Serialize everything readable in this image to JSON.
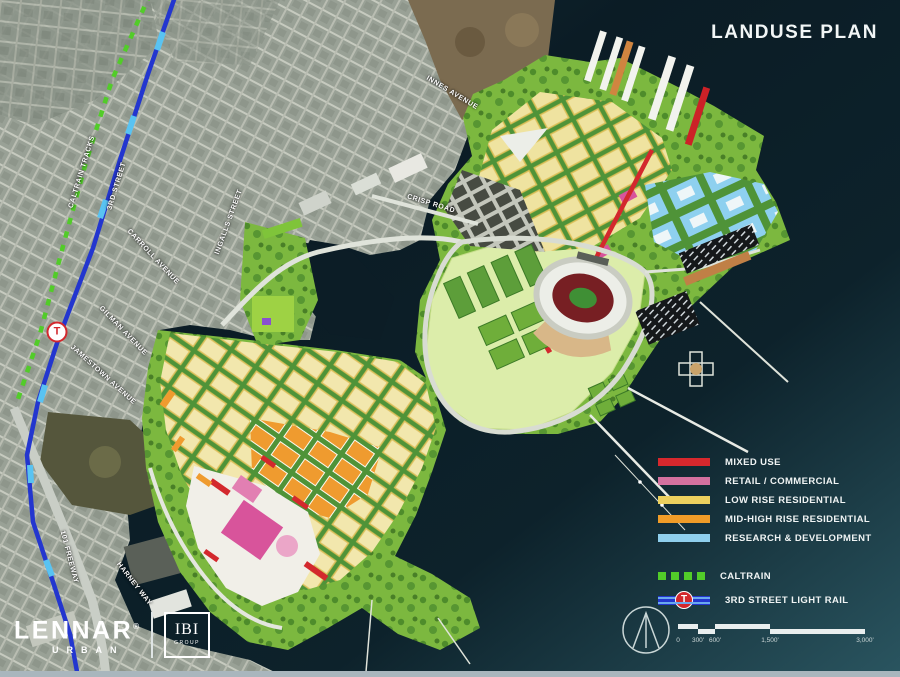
{
  "title": "LANDUSE PLAN",
  "legend": {
    "landuse_items": [
      {
        "label": "MIXED USE",
        "color": "#d7282d"
      },
      {
        "label": "RETAIL / COMMERCIAL",
        "color": "#d4719f"
      },
      {
        "label": "LOW RISE RESIDENTIAL",
        "color": "#ecd05e"
      },
      {
        "label": "MID-HIGH RISE RESIDENTIAL",
        "color": "#f09c28"
      },
      {
        "label": "RESEARCH & DEVELOPMENT",
        "color": "#8fcfed"
      }
    ],
    "transit_items": [
      {
        "label": "CALTRAIN",
        "color": "#52cc29",
        "style": "dashed"
      },
      {
        "label": "3RD STREET LIGHT RAIL",
        "color": "#2336cf",
        "badge": "T"
      }
    ]
  },
  "map": {
    "station_badge": "T",
    "streets": [
      {
        "label": "CALTRAIN TRACKS"
      },
      {
        "label": "3RD STREET"
      },
      {
        "label": "INGALLS STREET"
      },
      {
        "label": "CARROLL AVENUE"
      },
      {
        "label": "GILMAN AVENUE"
      },
      {
        "label": "JAMESTOWN AVENUE"
      },
      {
        "label": "INNES AVENUE"
      },
      {
        "label": "CRISP ROAD"
      },
      {
        "label": "HARNEY WAY"
      },
      {
        "label": "101 FREEWAY"
      }
    ]
  },
  "branding": {
    "lennar": "LENNAR",
    "lennar_reg": "®",
    "lennar_sub": "URBAN",
    "ibi": "IBI",
    "ibi_sub": "GROUP"
  },
  "scalebar": {
    "labels": [
      "0",
      "300'",
      "600'",
      "1,500'",
      "3,000'"
    ]
  },
  "colors": {
    "water_dark": "#0b1d26",
    "water_teal": "#2a5560",
    "urban_gray": "#99a196",
    "plan_green": "#7cb83f",
    "parkland_light": "#dcedaa",
    "mixed_use_red": "#d3282d",
    "retail_pink": "#d8549b",
    "low_rise_yellow": "#efe3a0",
    "mid_high_orange": "#ef9b2f",
    "rnd_blue": "#8ed0ef",
    "caltrain_green": "#52cc29",
    "light_rail_blue": "#2336cf",
    "stadium_seating": "#7c2024"
  }
}
